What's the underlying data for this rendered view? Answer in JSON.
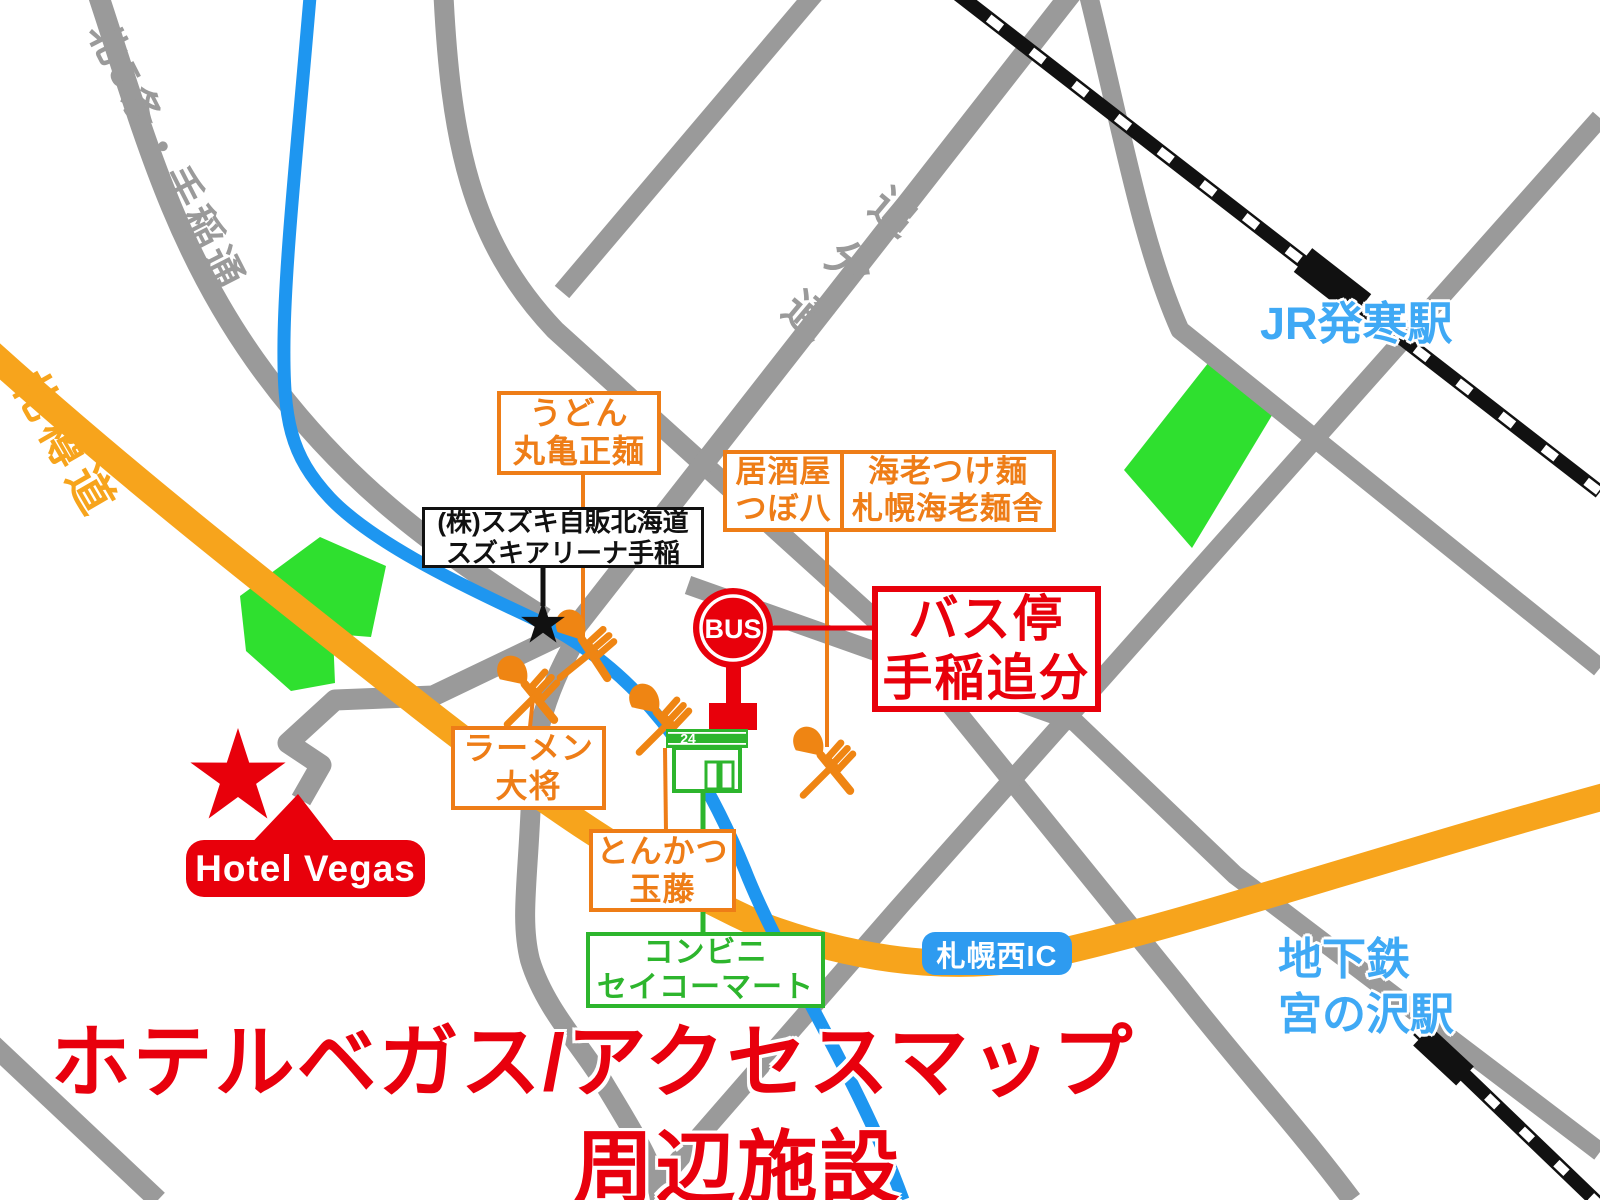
{
  "title": {
    "line1": "ホテルベガス/アクセスマップ",
    "line2": "周辺施設"
  },
  "roads": {
    "kita5jo": "北5条・手稲通",
    "sassondo": "札樽道",
    "oiwake": "追分通"
  },
  "stations": {
    "jr": "JR発寒駅",
    "subway_line1": "地下鉄",
    "subway_line2": "宮の沢駅",
    "interchange": "札幌西IC"
  },
  "pois": {
    "udon": {
      "line1": "うどん",
      "line2": "丸亀正麺"
    },
    "suzuki": {
      "line1": "(株)スズキ自販北海道",
      "line2": "スズキアリーナ手稲"
    },
    "izakaya": {
      "line1": "居酒屋",
      "line2": "つぼ八"
    },
    "ebi": {
      "line1": "海老つけ麺",
      "line2": "札幌海老麺舎"
    },
    "busstop": {
      "line1": "バス停",
      "line2": "手稲追分"
    },
    "ramen": {
      "line1": "ラーメン",
      "line2": "大将"
    },
    "tonkatsu": {
      "line1": "とんかつ",
      "line2": "玉藤"
    },
    "conbini": {
      "line1": "コンビニ",
      "line2": "セイコーマート"
    },
    "hotel": {
      "label": "Hotel Vegas"
    }
  },
  "icons": {
    "bus_sign": "BUS",
    "store_badge": "24"
  },
  "colors": {
    "road_gray": "#9A9A9A",
    "road_blue": "#1E96F0",
    "expressway_orange": "#F7A41C",
    "poi_orange": "#EE7D17",
    "accent_red": "#E8000B",
    "park_green": "#2FE02F",
    "store_green": "#2DB52D",
    "station_blue": "#3FA9F5",
    "ic_badge_blue": "#2E9BF0",
    "railway_black": "#111111"
  }
}
